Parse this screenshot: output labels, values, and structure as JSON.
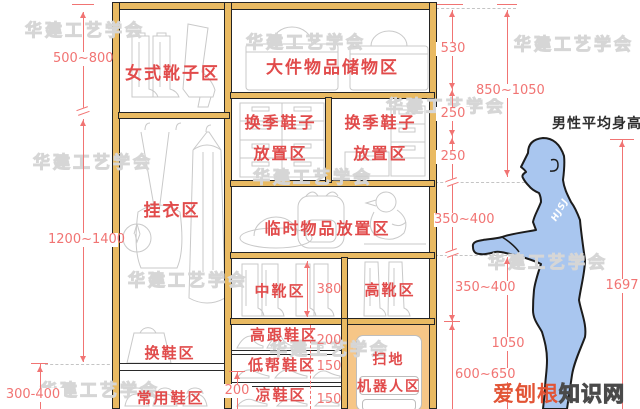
{
  "watermark": {
    "text": "华建工艺学会"
  },
  "badge": {
    "left": "爱刨根",
    "right": "知识网"
  },
  "person": {
    "label": "男性平均身高",
    "height": "1697",
    "sleeve_text": "HJSJ",
    "body_color": "#A9C6EF"
  },
  "cabinet": {
    "zones": {
      "women_boots": "女式靴子区",
      "large_storage": "大件物品储物区",
      "seasonal_line1": "换季鞋子",
      "seasonal_line2": "放置区",
      "hanging": "挂衣区",
      "temp_items": "临时物品放置区",
      "mid_boots": "中靴区",
      "high_boots": "高靴区",
      "high_heels": "高跟鞋区",
      "low_shoes": "低帮鞋区",
      "sandals": "凉鞋区",
      "shoe_change": "换鞋区",
      "daily_shoes": "常用鞋区",
      "robot_line1": "扫地",
      "robot_line2": "机器人区"
    },
    "colors": {
      "frame": "#E9BA62",
      "robot_bay": "#F6C687",
      "label_red": "#E14B4B",
      "dim_red": "#F17473"
    }
  },
  "dimensions": {
    "left_top": "500~800",
    "left_middle": "1200~1400",
    "left_bottom": "300-400",
    "top_section": "530",
    "seasonal_upper": "250",
    "seasonal_lower": "250",
    "upper_total": "850~1050",
    "temp_section": "350~400",
    "boot_section": "350~400",
    "counter_height": "1050",
    "lower_section": "600~650",
    "mid_boot_height": "380",
    "heels_height": "200",
    "low_shoes_height": "150",
    "sandals_height": "150",
    "kick_height": "200"
  }
}
